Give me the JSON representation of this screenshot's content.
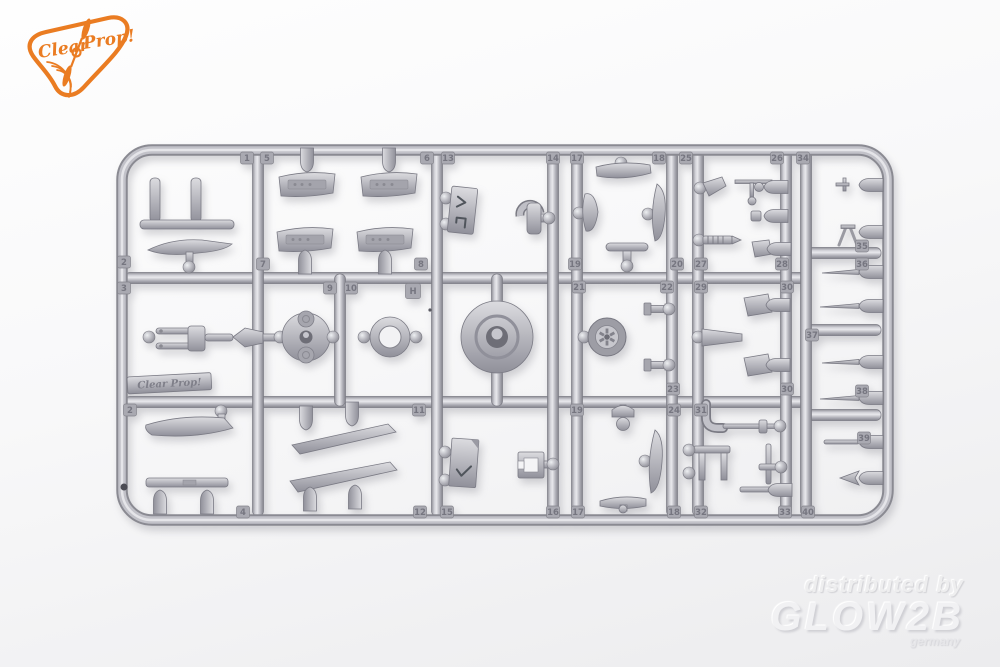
{
  "page": {
    "width": 1000,
    "height": 667,
    "background_top": "#fdfdfd",
    "background_bottom": "#ececee"
  },
  "logo": {
    "brand": "Clear Prop!",
    "word1": "Clear",
    "word2": "Prop!",
    "color": "#ea7c22"
  },
  "watermark": {
    "line1": "distributed by",
    "line2": "GLOW2B",
    "line3": "germany",
    "color": "#f0f0f2"
  },
  "sprue": {
    "material_color": "#b9b9bf",
    "brand_plate": {
      "text": "Clear Prop!"
    },
    "mold_mark": "H",
    "parts": [
      "boarding-step",
      "curved-blade",
      "instrument-panels",
      "placard-plate",
      "tow-hook",
      "propeller-blades",
      "t-handle",
      "fin",
      "screw",
      "torque-link-fork",
      "engine-cylinder-drum",
      "cowl-ring",
      "cowling-front-disc",
      "main-wheel",
      "bolts",
      "cone-fairing",
      "cowl-flaps",
      "strut-strips",
      "checked-plate",
      "bracket",
      "knob",
      "tailplane",
      "exhaust-pipe",
      "bench-frame",
      "flanged-rod",
      "antenna",
      "trestle",
      "pitot-tubes",
      "rod",
      "arrow-dart"
    ],
    "tags": [
      {
        "label": "1",
        "x": 247,
        "y": 158
      },
      {
        "label": "5",
        "x": 267,
        "y": 158
      },
      {
        "label": "6",
        "x": 427,
        "y": 158
      },
      {
        "label": "13",
        "x": 448,
        "y": 158
      },
      {
        "label": "14",
        "x": 553,
        "y": 158
      },
      {
        "label": "17",
        "x": 577,
        "y": 158
      },
      {
        "label": "18",
        "x": 659,
        "y": 158
      },
      {
        "label": "25",
        "x": 686,
        "y": 158
      },
      {
        "label": "26",
        "x": 777,
        "y": 158
      },
      {
        "label": "34",
        "x": 803,
        "y": 158
      },
      {
        "label": "2",
        "x": 124,
        "y": 262
      },
      {
        "label": "7",
        "x": 263,
        "y": 264
      },
      {
        "label": "8",
        "x": 421,
        "y": 264
      },
      {
        "label": "19",
        "x": 575,
        "y": 264
      },
      {
        "label": "20",
        "x": 677,
        "y": 264
      },
      {
        "label": "27",
        "x": 701,
        "y": 264
      },
      {
        "label": "28",
        "x": 782,
        "y": 264
      },
      {
        "label": "3",
        "x": 124,
        "y": 288
      },
      {
        "label": "9",
        "x": 330,
        "y": 288
      },
      {
        "label": "10",
        "x": 351,
        "y": 288
      },
      {
        "label": "H",
        "x": 413,
        "y": 291
      },
      {
        "label": "21",
        "x": 579,
        "y": 287
      },
      {
        "label": "22",
        "x": 667,
        "y": 287
      },
      {
        "label": "29",
        "x": 701,
        "y": 287
      },
      {
        "label": "30",
        "x": 787,
        "y": 287
      },
      {
        "label": "35",
        "x": 862,
        "y": 246
      },
      {
        "label": "36",
        "x": 862,
        "y": 264
      },
      {
        "label": "37",
        "x": 812,
        "y": 335
      },
      {
        "label": "23",
        "x": 673,
        "y": 389
      },
      {
        "label": "30",
        "x": 787,
        "y": 389
      },
      {
        "label": "38",
        "x": 862,
        "y": 391
      },
      {
        "label": "39",
        "x": 864,
        "y": 438
      },
      {
        "label": "2",
        "x": 130,
        "y": 410
      },
      {
        "label": "11",
        "x": 419,
        "y": 410
      },
      {
        "label": "19",
        "x": 577,
        "y": 410
      },
      {
        "label": "24",
        "x": 674,
        "y": 410
      },
      {
        "label": "31",
        "x": 701,
        "y": 410
      },
      {
        "label": "4",
        "x": 243,
        "y": 512
      },
      {
        "label": "12",
        "x": 420,
        "y": 512
      },
      {
        "label": "15",
        "x": 447,
        "y": 512
      },
      {
        "label": "16",
        "x": 553,
        "y": 512
      },
      {
        "label": "17",
        "x": 578,
        "y": 512
      },
      {
        "label": "18",
        "x": 674,
        "y": 512
      },
      {
        "label": "32",
        "x": 701,
        "y": 512
      },
      {
        "label": "33",
        "x": 785,
        "y": 512
      },
      {
        "label": "40",
        "x": 808,
        "y": 512
      }
    ]
  }
}
